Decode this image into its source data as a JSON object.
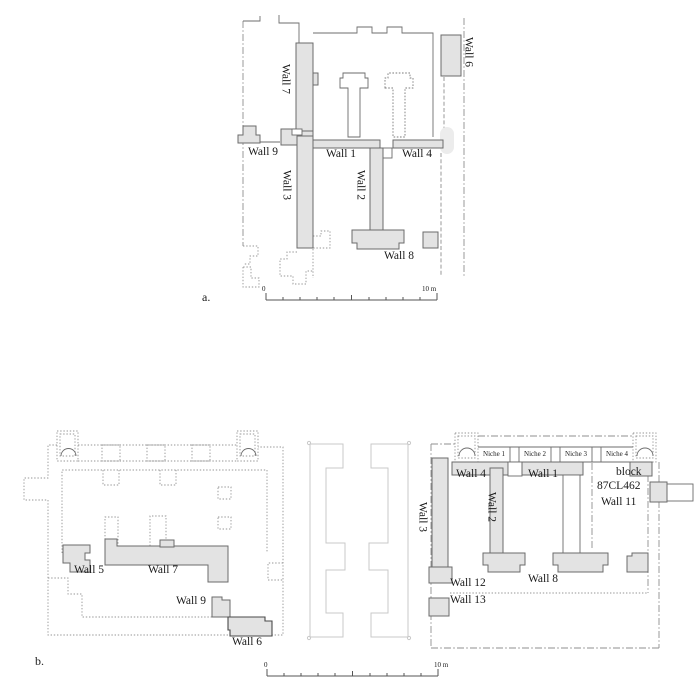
{
  "figure": {
    "panels": {
      "a": "a.",
      "b": "b."
    },
    "scale_bar": {
      "zero": "0",
      "ten": "10 m"
    },
    "colors": {
      "wall_fill": "#e3e3e3",
      "wall_outline": "#6b6b6b",
      "boundary": "#8f8f8f",
      "ghost_outline": "#c9c9c9",
      "text": "#1a1a1a"
    }
  },
  "plan_a": {
    "wall1": "Wall 1",
    "wall2": "Wall 2",
    "wall3": "Wall 3",
    "wall4": "Wall 4",
    "wall6": "Wall 6",
    "wall7": "Wall 7",
    "wall8": "Wall 8",
    "wall9": "Wall 9"
  },
  "plan_b": {
    "left": {
      "wall5": "Wall 5",
      "wall6": "Wall 6",
      "wall7": "Wall 7",
      "wall9": "Wall 9"
    },
    "middle": {
      "wall3": "Wall 3"
    },
    "right": {
      "niche1": "Niche 1",
      "niche2": "Niche 2",
      "niche3": "Niche 3",
      "niche4": "Niche 4",
      "wall1": "Wall 1",
      "wall2": "Wall 2",
      "wall4": "Wall 4",
      "wall8": "Wall 8",
      "wall11": "Wall 11",
      "wall12": "Wall 12",
      "wall13": "Wall 13",
      "block_line1": "block",
      "block_line2": "87CL462"
    }
  }
}
